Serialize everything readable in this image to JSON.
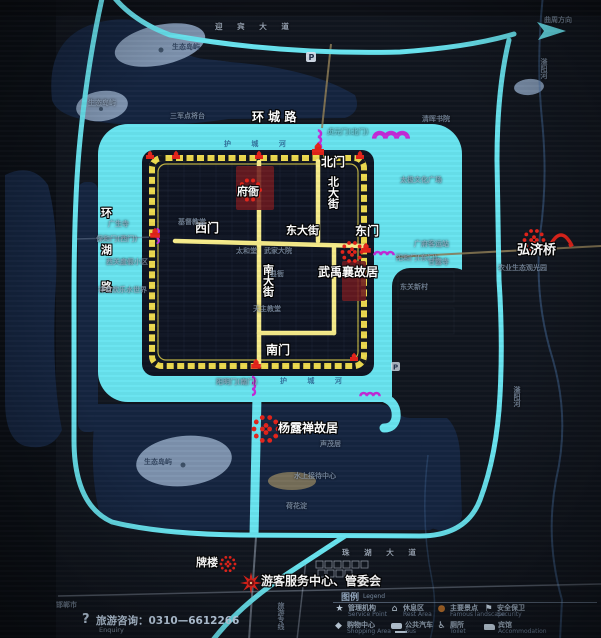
{
  "poi": {
    "fuya": "府衙",
    "wu_yuxiang": "武禹襄故居",
    "yang_luchan": "杨露禅故居",
    "hongji_bridge": "弘济桥",
    "pailou": "牌楼",
    "visitor_center": "游客服务中心、管委会"
  },
  "gates": {
    "north": "北门",
    "west": "西门",
    "east": "东门",
    "south": "南门"
  },
  "streets": {
    "north_st": "北大街",
    "south_st": "南大街",
    "east_st": "东大街",
    "ring_city": "环 城 路",
    "ring_lake": "环湖路"
  },
  "roads": {
    "yingbin": "迎 宾 大 道",
    "zhuhu": "珠 湖 大 道",
    "tour_line": "旅游专线",
    "quzhou_dir": "曲周方向",
    "handan": "邯郸市"
  },
  "water": {
    "moat": "护 城 河",
    "fuyang_river": "滏阳河"
  },
  "faint": [
    "三军点将台",
    "太极文化广场",
    "贞元门(北门)",
    "保和门(西门)",
    "阳和门(东门)",
    "阳明门(南门)",
    "广府客运站",
    "甘露寺",
    "东关新村",
    "清晖书院",
    "农业生态观光园",
    "广生寺",
    "西关度假小区",
    "祥龙欢乐水世界",
    "基督教堂",
    "太和堂",
    "武家大院",
    "天主教堂",
    "县衙",
    "生态岛屿",
    "生态岛屿",
    "生态岛屿",
    "水上接待中心",
    "荷花淀",
    "声茂居"
  ],
  "legend": {
    "title": "图例",
    "title_en": "Legend",
    "items": [
      {
        "zh": "管理机构",
        "en": "Service Point",
        "icon": "star"
      },
      {
        "zh": "休息区",
        "en": "Rest Area",
        "icon": "pavilion"
      },
      {
        "zh": "主要景点",
        "en": "Famous landscape",
        "icon": "dot"
      },
      {
        "zh": "安全保卫",
        "en": "Security",
        "icon": "guard"
      },
      {
        "zh": "购物中心",
        "en": "Shopping Area",
        "icon": "bag"
      },
      {
        "zh": "公共汽车",
        "en": "Bus",
        "icon": "bus"
      },
      {
        "zh": "厕所",
        "en": "Toilet",
        "icon": "toilet"
      },
      {
        "zh": "宾馆",
        "en": "Accommodation",
        "icon": "bed"
      }
    ]
  },
  "hotline": {
    "q": "?",
    "text": "旅游咨询：0310—6612266",
    "en": "Enquiry"
  },
  "colors": {
    "moat": "#68e4f0",
    "wall": "#ecd94e",
    "street": "#f7ec8a",
    "marker_red": "#e3231a",
    "bridge_magenta": "#c32bd9",
    "lake": "#152540",
    "island": "#7e93ae"
  }
}
